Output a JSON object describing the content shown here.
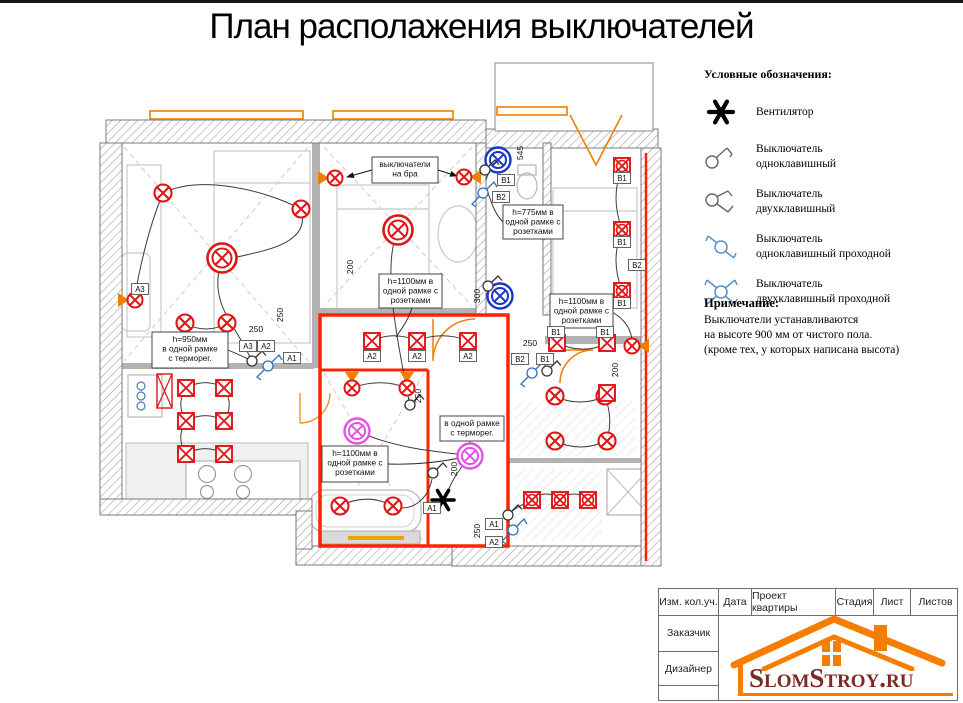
{
  "title": "План располажения выключателей",
  "legend": {
    "heading": "Условные обозначения:",
    "items": [
      {
        "icon": "fan-icon",
        "label": "Вентилятор"
      },
      {
        "icon": "switch-single-icon",
        "label": "Выключатель\nодноклавишный"
      },
      {
        "icon": "switch-double-icon",
        "label": "Выключатель\nдвухклавишный"
      },
      {
        "icon": "switch-single-pass-icon",
        "label": "Выключатель\nодноклавишный проходной"
      },
      {
        "icon": "switch-double-pass-icon",
        "label": "Выключатель\nдвухклавишный проходной"
      }
    ]
  },
  "note": {
    "heading": "Примечание:",
    "text": "Выключатели устанавливаются\nна высоте 900 мм от чистого пола.\n(кроме тех, у которых написана высота)"
  },
  "titleblock": {
    "header_cells": [
      "Изм. кол.уч.",
      "Дата",
      "Проект квартиры",
      "Стадия",
      "Лист",
      "Листов"
    ],
    "side_rows": [
      "Заказчик",
      "Дизайнер",
      ""
    ],
    "logo_text": "SlomStroy.ru"
  },
  "plan": {
    "colors": {
      "symbol_red": "#e21313",
      "wall_red": "#fb2400",
      "symbol_blue": "#1b35c8",
      "symbol_magenta": "#e452e4",
      "orange": "#ef7f00",
      "legend_blue": "#5b8fc9"
    },
    "callouts": [
      {
        "x": 372,
        "y": 154,
        "w": 66,
        "h": 26,
        "lines": [
          "выключатели",
          "на бра"
        ]
      },
      {
        "x": 503,
        "y": 202,
        "w": 60,
        "h": 34,
        "lines": [
          "h=775мм в",
          "одной рамке с",
          "розетками"
        ]
      },
      {
        "x": 379,
        "y": 271,
        "w": 63,
        "h": 34,
        "lines": [
          "h=1100мм в",
          "одной рамке с",
          "розетками"
        ]
      },
      {
        "x": 550,
        "y": 291,
        "w": 63,
        "h": 34,
        "lines": [
          "h=1100мм в",
          "одной рамке с",
          "розетками"
        ]
      },
      {
        "x": 152,
        "y": 329,
        "w": 76,
        "h": 36,
        "lines": [
          "h=950мм",
          "в одной рамке",
          "с терморег."
        ]
      },
      {
        "x": 440,
        "y": 413,
        "w": 64,
        "h": 25,
        "lines": [
          "в одной рамке",
          "с терморег."
        ]
      },
      {
        "x": 322,
        "y": 443,
        "w": 66,
        "h": 36,
        "lines": [
          "h=1100мм в",
          "одной рамке с",
          "розетками"
        ]
      }
    ],
    "tags": [
      {
        "t": "A3",
        "x": 140,
        "y": 286
      },
      {
        "t": "A3",
        "x": 248,
        "y": 343
      },
      {
        "t": "A2",
        "x": 266,
        "y": 343
      },
      {
        "t": "A1",
        "x": 292,
        "y": 355
      },
      {
        "t": "A2",
        "x": 372,
        "y": 353
      },
      {
        "t": "A2",
        "x": 417,
        "y": 353
      },
      {
        "t": "A2",
        "x": 468,
        "y": 353
      },
      {
        "t": "A1",
        "x": 432,
        "y": 505
      },
      {
        "t": "A1",
        "x": 494,
        "y": 521
      },
      {
        "t": "A2",
        "x": 494,
        "y": 539
      },
      {
        "t": "B1",
        "x": 506,
        "y": 177
      },
      {
        "t": "B2",
        "x": 501,
        "y": 194
      },
      {
        "t": "B2",
        "x": 520,
        "y": 356
      },
      {
        "t": "B1",
        "x": 545,
        "y": 356
      },
      {
        "t": "B1",
        "x": 556,
        "y": 329
      },
      {
        "t": "B1",
        "x": 605,
        "y": 329
      },
      {
        "t": "B1",
        "x": 622,
        "y": 175
      },
      {
        "t": "B1",
        "x": 622,
        "y": 239
      },
      {
        "t": "B1",
        "x": 622,
        "y": 300
      },
      {
        "t": "B2",
        "x": 637,
        "y": 262
      }
    ],
    "dims": [
      {
        "t": "250",
        "x": 256,
        "y": 329,
        "rot": 0
      },
      {
        "t": "250",
        "x": 283,
        "y": 312,
        "rot": 1
      },
      {
        "t": "545",
        "x": 523,
        "y": 150,
        "rot": 1
      },
      {
        "t": "300",
        "x": 480,
        "y": 293,
        "rot": 1
      },
      {
        "t": "250",
        "x": 530,
        "y": 343,
        "rot": 0
      },
      {
        "t": "200",
        "x": 353,
        "y": 264,
        "rot": 1
      },
      {
        "t": "200",
        "x": 457,
        "y": 466,
        "rot": 1
      },
      {
        "t": "250",
        "x": 480,
        "y": 528,
        "rot": 1
      },
      {
        "t": "200",
        "x": 618,
        "y": 367,
        "rot": 1
      },
      {
        "t": "250",
        "x": 421,
        "y": 393,
        "rot": 1
      }
    ],
    "symbols": {
      "ceiling_lights_large": [
        [
          222,
          255
        ],
        [
          398,
          227
        ]
      ],
      "ceiling_lights": [
        [
          163,
          190
        ],
        [
          301,
          206
        ],
        [
          185,
          320
        ],
        [
          227,
          320
        ],
        [
          555,
          393
        ],
        [
          605,
          393
        ],
        [
          555,
          438
        ],
        [
          607,
          438
        ],
        [
          340,
          503
        ],
        [
          393,
          503
        ]
      ],
      "wet_lights_blue": [
        [
          498,
          157
        ],
        [
          500,
          293
        ]
      ],
      "accent_lights_magenta": [
        [
          357,
          428
        ],
        [
          470,
          453
        ]
      ],
      "wall_sconces": [
        {
          "x": 135,
          "y": 297,
          "dir": "right"
        },
        {
          "x": 335,
          "y": 175,
          "dir": "right"
        },
        {
          "x": 464,
          "y": 174,
          "dir": "left"
        },
        {
          "x": 352,
          "y": 385,
          "dir": "down"
        },
        {
          "x": 407,
          "y": 385,
          "dir": "down"
        },
        {
          "x": 632,
          "y": 343,
          "dir": "left"
        }
      ],
      "spot_squares": [
        [
          372,
          338
        ],
        [
          417,
          338
        ],
        [
          468,
          338
        ],
        [
          557,
          340
        ],
        [
          607,
          340
        ],
        [
          607,
          390
        ],
        [
          186,
          385
        ],
        [
          224,
          385
        ],
        [
          186,
          418
        ],
        [
          224,
          418
        ],
        [
          186,
          451
        ],
        [
          224,
          451
        ]
      ],
      "spot_squares_round": [
        [
          622,
          163
        ],
        [
          622,
          227
        ],
        [
          622,
          288
        ],
        [
          532,
          497
        ],
        [
          560,
          497
        ],
        [
          588,
          497
        ]
      ],
      "fans": [
        [
          443,
          497
        ]
      ],
      "switches_single": [
        [
          252,
          358
        ],
        [
          410,
          402
        ],
        [
          433,
          470
        ],
        [
          508,
          512
        ],
        [
          547,
          368
        ],
        [
          485,
          167
        ],
        [
          488,
          283
        ]
      ],
      "switches_pass": [
        [
          268,
          363
        ],
        [
          513,
          527
        ],
        [
          532,
          370
        ],
        [
          483,
          190
        ]
      ]
    }
  }
}
